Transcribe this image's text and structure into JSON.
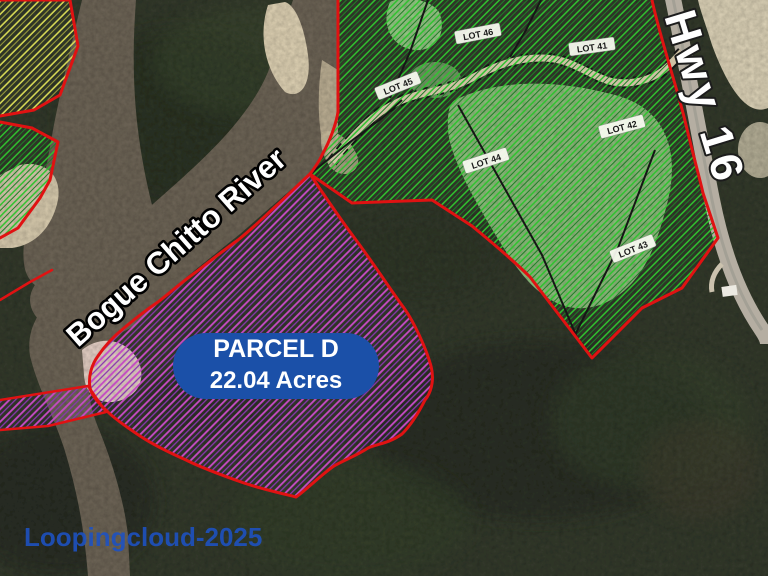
{
  "map": {
    "river_label": "Bogue Chitto River",
    "highway_label": "Hwy 16",
    "watermark": "Loopingcloud-2025",
    "badge": {
      "parcel_name": "PARCEL D",
      "acreage": "22.04 Acres"
    },
    "lots": [
      {
        "label": "LOT 41"
      },
      {
        "label": "LOT 42"
      },
      {
        "label": "LOT 43"
      },
      {
        "label": "LOT 44"
      },
      {
        "label": "LOT 45"
      },
      {
        "label": "LOT 46"
      }
    ],
    "colors": {
      "boundary_red": "#e01212",
      "parcel_d_hatch": "#c44ac4",
      "lot_hatch_green": "#2fc32f",
      "left_parcel_hatch_yellow": "#d6d855",
      "badge_blue": "#1b50a8",
      "watermark_blue": "#1d52c4"
    }
  }
}
